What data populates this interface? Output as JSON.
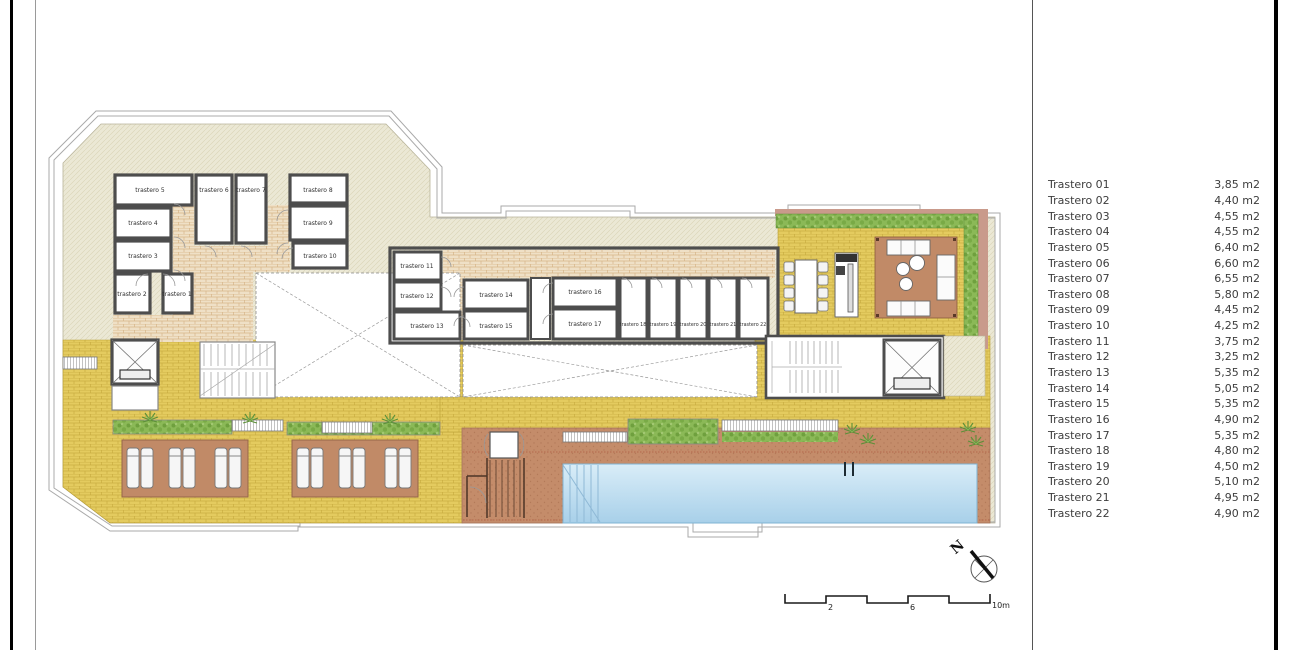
{
  "legend": {
    "rows": [
      {
        "label": "Trastero 01",
        "area": "3,85 m2"
      },
      {
        "label": "Trastero 02",
        "area": "4,40 m2"
      },
      {
        "label": "Trastero 03",
        "area": "4,55 m2"
      },
      {
        "label": "Trastero 04",
        "area": "4,55 m2"
      },
      {
        "label": "Trastero 05",
        "area": "6,40 m2"
      },
      {
        "label": "Trastero 06",
        "area": "6,60 m2"
      },
      {
        "label": "Trastero 07",
        "area": "6,55 m2"
      },
      {
        "label": "Trastero 08",
        "area": "5,80 m2"
      },
      {
        "label": "Trastero 09",
        "area": "4,45 m2"
      },
      {
        "label": "Trastero 10",
        "area": "4,25 m2"
      },
      {
        "label": "Trastero 11",
        "area": "3,75 m2"
      },
      {
        "label": "Trastero 12",
        "area": "3,25 m2"
      },
      {
        "label": "Trastero 13",
        "area": "5,35 m2"
      },
      {
        "label": "Trastero 14",
        "area": "5,05 m2"
      },
      {
        "label": "Trastero 15",
        "area": "5,35 m2"
      },
      {
        "label": "Trastero 16",
        "area": "4,90 m2"
      },
      {
        "label": "Trastero 17",
        "area": "5,35 m2"
      },
      {
        "label": "Trastero 18",
        "area": "4,80 m2"
      },
      {
        "label": "Trastero 19",
        "area": "4,50 m2"
      },
      {
        "label": "Trastero 20",
        "area": "5,10 m2"
      },
      {
        "label": "Trastero 21",
        "area": "4,95 m2"
      },
      {
        "label": "Trastero 22",
        "area": "4,90 m2"
      }
    ]
  },
  "plan": {
    "rooms": [
      "trastero 1",
      "trastero 2",
      "trastero 3",
      "trastero 4",
      "trastero 5",
      "trastero 6",
      "trastero 7",
      "trastero 8",
      "trastero 9",
      "trastero 10",
      "trastero 11",
      "trastero 12",
      "trastero 13",
      "trastero 14",
      "trastero 15",
      "trastero 16",
      "trastero 17",
      "trastero 18",
      "trastero 19",
      "trastero 20",
      "trastero 21",
      "trastero 22"
    ],
    "north_label": "N",
    "scale_bar": {
      "tick_2": "2",
      "tick_6": "6",
      "tick_10": "10m"
    }
  },
  "colors": {
    "paving_yellow": "#e4cb5f",
    "corridor_brick": "#efe0c6",
    "deck_terracotta": "#c48c6a",
    "pool_water": "#bcdcee",
    "hedge_green": "#8bb957",
    "roof_beige": "#ebe8d5",
    "wall_gray": "#4d4d4d"
  }
}
